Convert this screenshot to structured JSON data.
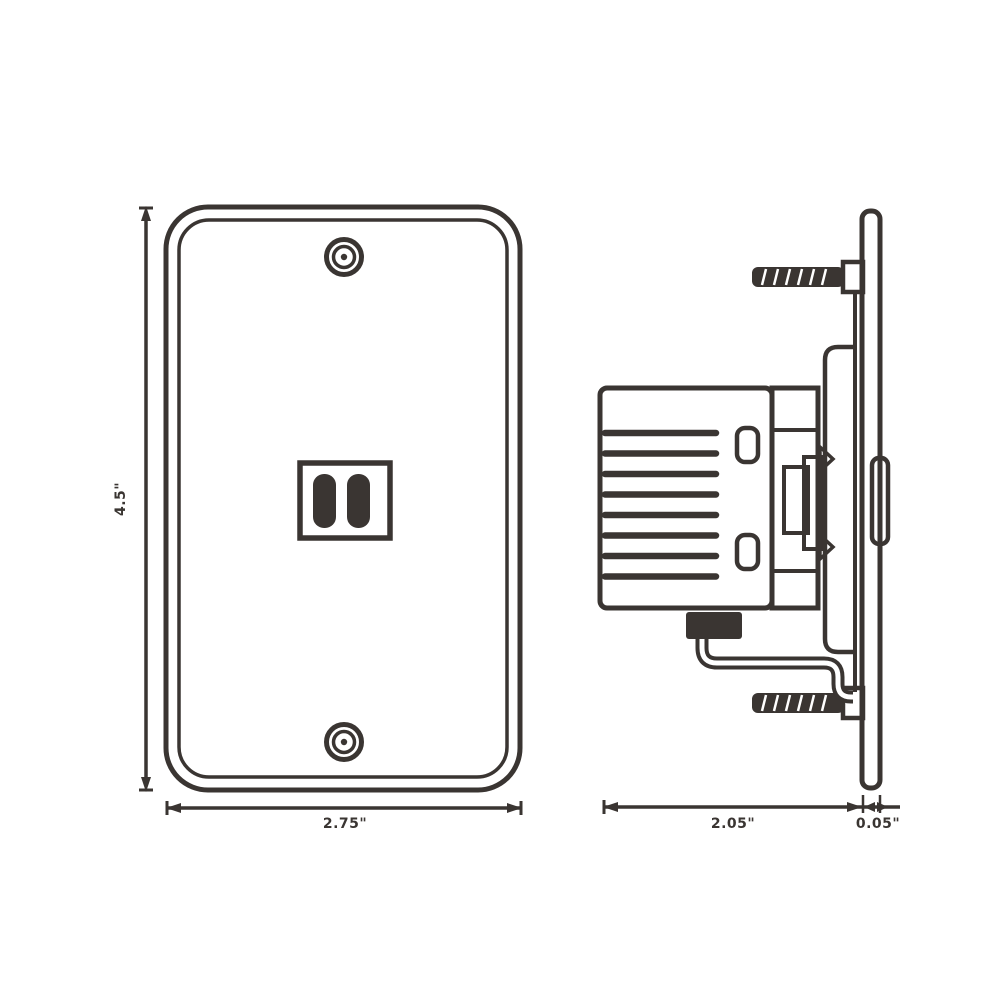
{
  "drawing": {
    "type": "technical-dimension-drawing",
    "subject": "telephone jack wall plate - front and side views",
    "line_color": "#3a3532",
    "background_color": "#ffffff",
    "dimensions": {
      "front_height": "4.5\"",
      "front_width": "2.75\"",
      "side_depth": "2.05\"",
      "plate_thickness": "0.05\""
    }
  }
}
